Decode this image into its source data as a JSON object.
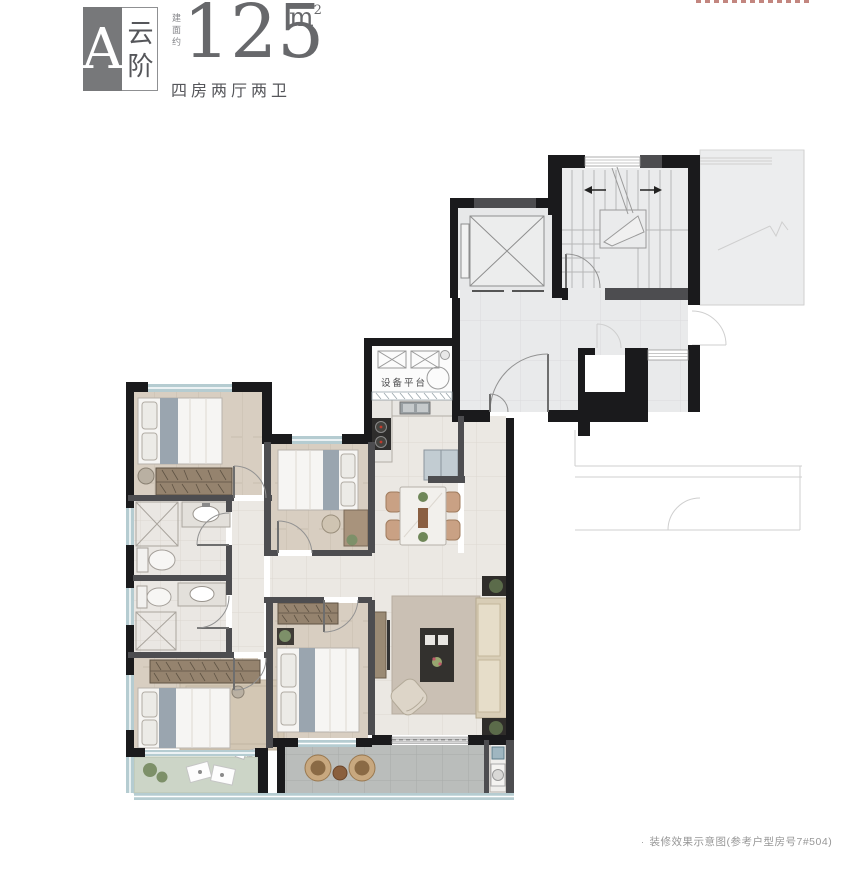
{
  "header": {
    "block_letter": "A",
    "block_name": "云阶",
    "area_label": "建面约",
    "area_value": "125",
    "area_unit_base": "m",
    "area_unit_sup": "2",
    "layout_desc": "四房两厅两卫"
  },
  "plan": {
    "labels": {
      "equipment_platform": "设备平台"
    }
  },
  "footer": {
    "bullet": "·",
    "note": "装修效果示意图(参考户型房号7#504)"
  },
  "colors": {
    "wall": "#1a1a1c",
    "wallg": "#4d4d50",
    "win": "#b5ccd1",
    "wood": "#d8cec1",
    "tile": "#ebe8e3",
    "balc": "#babdbb",
    "planter": "#ccd5c7",
    "common": "#e9eaeb",
    "textDark": "#55565a",
    "textGray": "#979797",
    "logoGray": "#77787a",
    "red": "#a2443a"
  }
}
